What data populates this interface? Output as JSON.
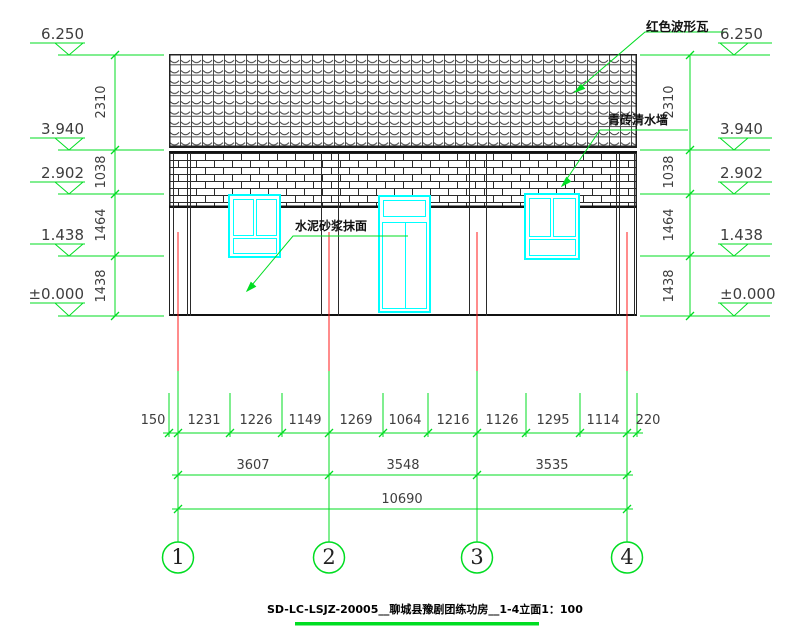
{
  "meta": {
    "drawing_type": "elevation"
  },
  "colors": {
    "annotation_green": "#00dd22",
    "grid_red": "#ff1a1a",
    "joinery_cyan": "#00ffff",
    "ink": "#1a1a1a",
    "dim_text": "#3d3d3d"
  },
  "labels": {
    "roof": "红色波形瓦",
    "brick": "青砖清水墙",
    "plaster": "水泥砂浆抹面"
  },
  "elevations": {
    "values": [
      "6.250",
      "3.940",
      "2.902",
      "1.438",
      "±0.000"
    ]
  },
  "vdims": {
    "values": [
      "2310",
      "1038",
      "1464",
      "1438"
    ]
  },
  "dims": {
    "row1": [
      "150",
      "1231",
      "1226",
      "1149",
      "1269",
      "1064",
      "1216",
      "1126",
      "1295",
      "1114",
      "220"
    ],
    "row2": [
      "3607",
      "3548",
      "3535"
    ],
    "total": "10690"
  },
  "axes": [
    "1",
    "2",
    "3",
    "4"
  ],
  "title": {
    "text": "SD-LC-LSJZ-20005__聊城县豫剧团练功房__1-4立面1：100"
  }
}
